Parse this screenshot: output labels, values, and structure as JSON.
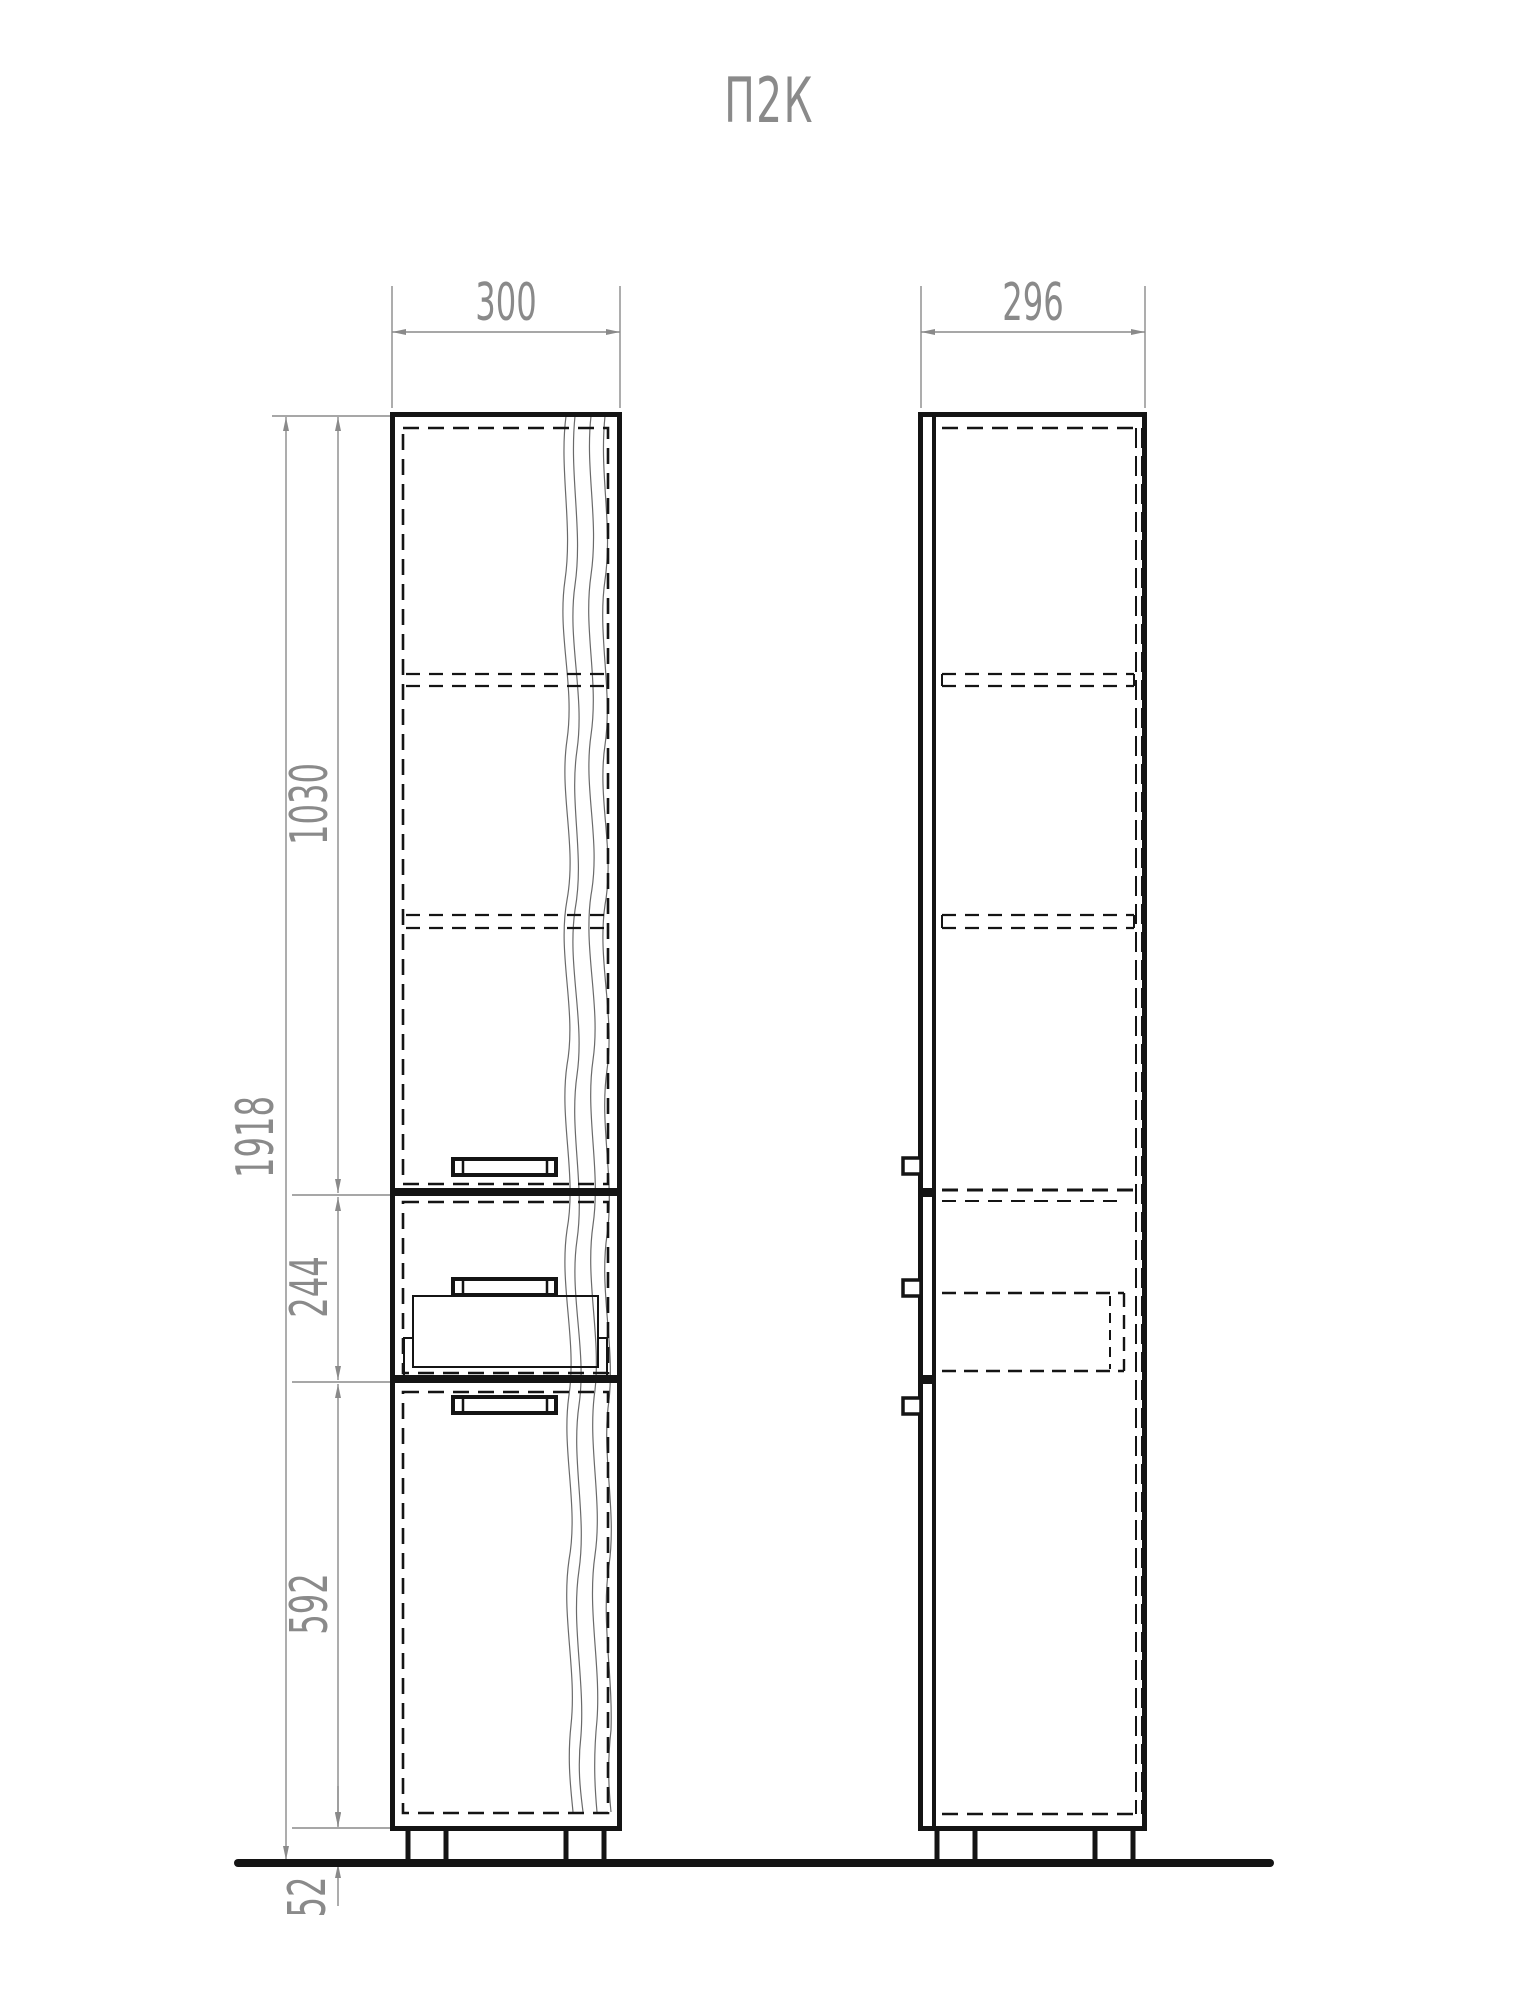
{
  "title": "П2К",
  "drawing": {
    "front_view": {
      "width_label": "300",
      "total_height_label": "1918",
      "upper_section_label": "1030",
      "drawer_section_label": "244",
      "lower_section_label": "592",
      "plinth_height_label": "52"
    },
    "side_view": {
      "depth_label": "296"
    }
  },
  "colors": {
    "cabinet_line": "#141414",
    "dimension_line": "#8a8a8a",
    "wood_grain": "#6a6a6a",
    "background": "#ffffff"
  }
}
